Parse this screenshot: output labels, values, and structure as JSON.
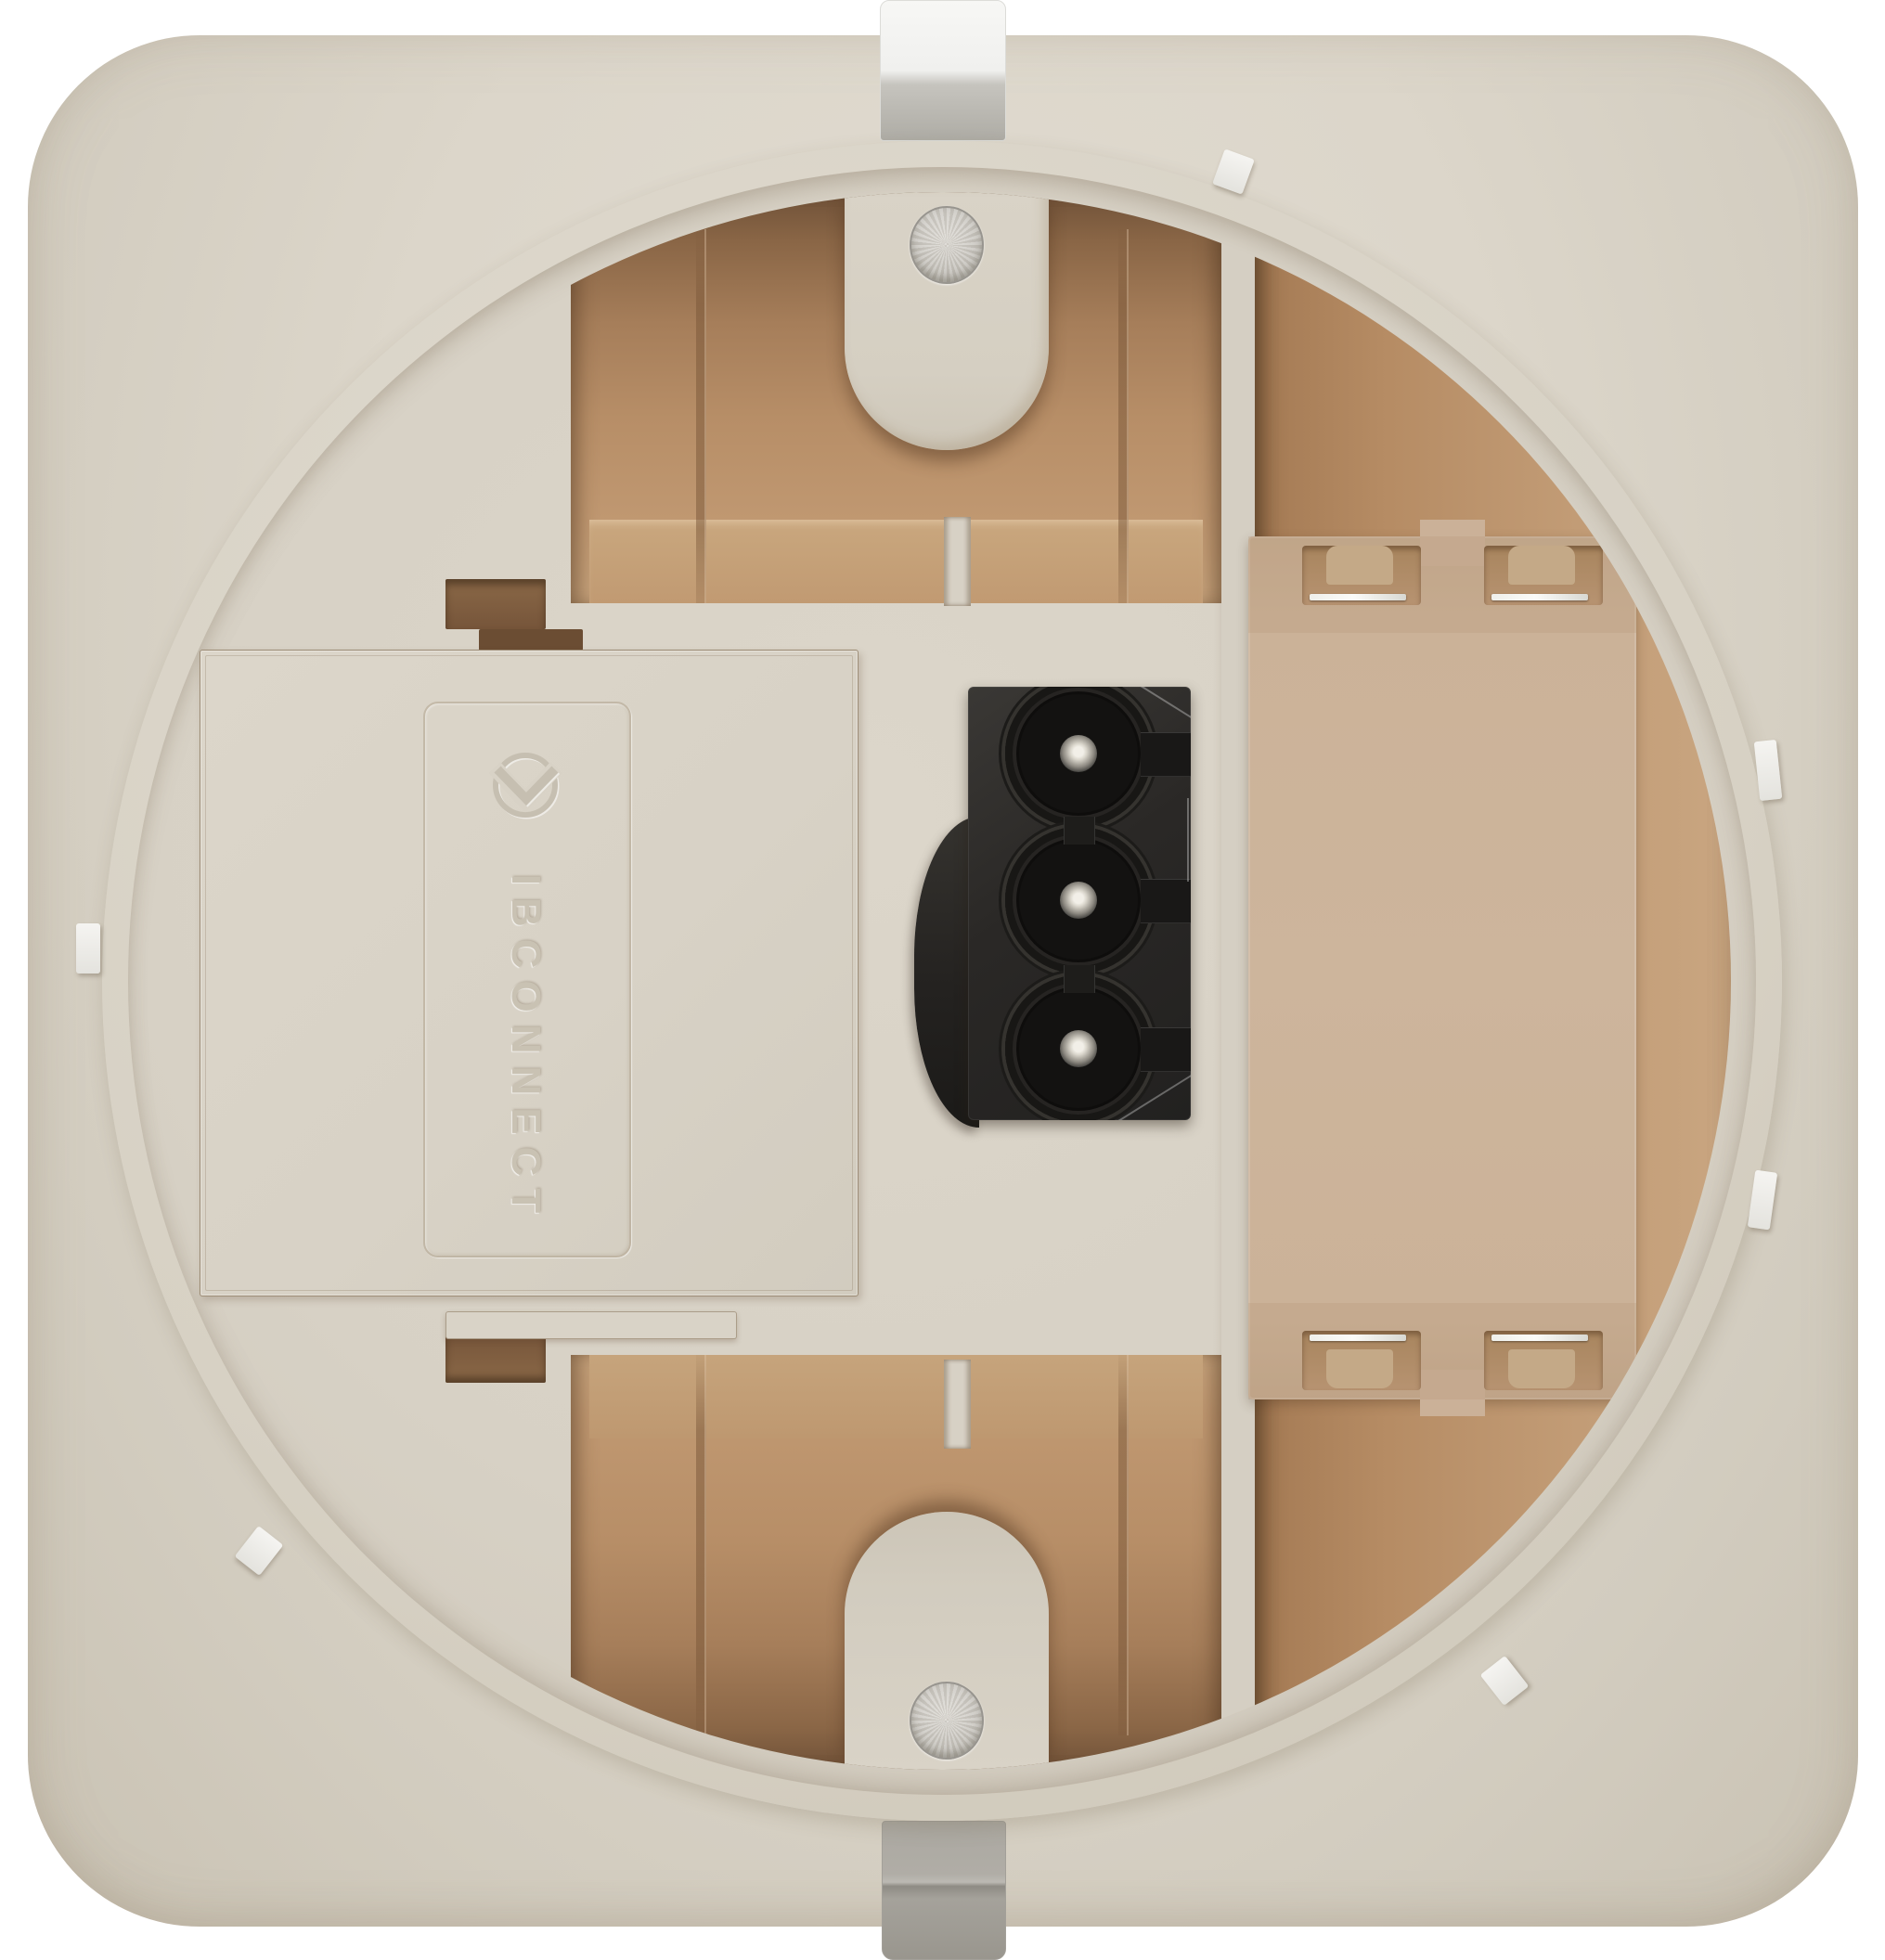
{
  "meta": {
    "type": "product-photo-render",
    "subject": "Rear side of a beige flush-mount wall device with cable cover door, embossed brand logo, 3-pole plug connector, recessed compartments, module bay contacts, mounting clips and screws",
    "background": "#ffffff"
  },
  "branding": {
    "text": "IBCONNECT",
    "logo": "chevron-circle-icon"
  },
  "connector": {
    "pole_count": 3
  },
  "colors": {
    "bg": "#ffffff",
    "plate": "#d8d2c6",
    "plate-light": "#e1dcd2",
    "plate-dark": "#c9c2b3",
    "cream": "#d8d2c6",
    "cream-light": "#dcd6ca",
    "tan": "#be9670",
    "tan-dark": "#6f5138",
    "tan-mid": "#a67e5a",
    "tan-light": "#c9a77e",
    "bay": "#ccb399",
    "bay-dark": "#a8855e",
    "emboss": "#c9c2b3",
    "outline": "#8c7152",
    "blk": "#262422",
    "blk-deep": "#131211",
    "metal-light": "#f4f3ef",
    "metal-dark": "#9a978f",
    "screw": "#ccc9c3"
  }
}
